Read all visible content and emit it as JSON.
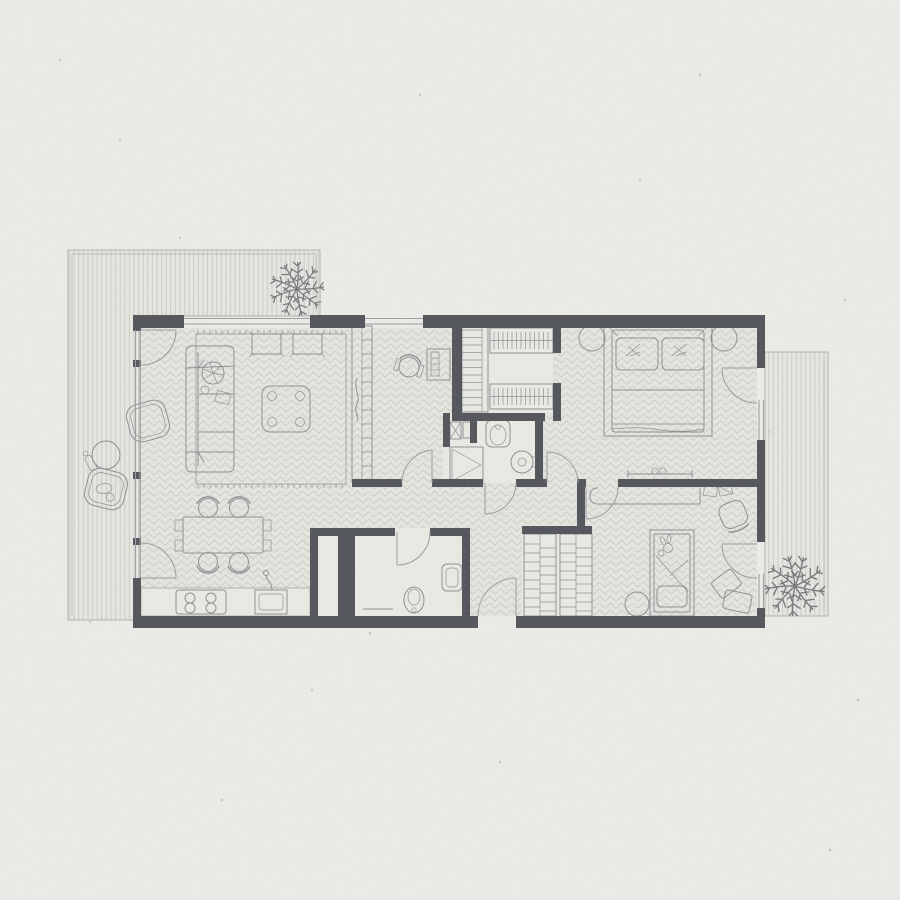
{
  "canvas": {
    "width": 900,
    "height": 900
  },
  "palette": {
    "paper": "#ecebe7",
    "wall": "#53565b",
    "floor_bg": "#e5e4df",
    "floor_line": "#c9c8c3",
    "deck_bg": "#e7e6e1",
    "deck_line": "#c6c5c0",
    "bath_bg": "#eae9e4",
    "furniture_stroke": "#8e9195",
    "furniture_fill": "#e9e8e3",
    "light_stroke": "#b2b1ac",
    "window_stroke": "#9aa0a4",
    "door_stroke": "#9a9da1",
    "plant_stroke": "#75787c",
    "speck": "#b5b3ae"
  },
  "floorplan": {
    "type": "apartment-top-view",
    "outdoor": {
      "left_terrace": {
        "surface": "deck-boards",
        "items": [
          "potted-fern",
          "lounge-chair",
          "lounge-chair",
          "round-side-table"
        ]
      },
      "right_terrace": {
        "surface": "deck-boards",
        "items": [
          "potted-fern"
        ]
      }
    },
    "rooms": [
      {
        "id": "living-dining",
        "floor": "herringbone",
        "items": [
          "sofa",
          "sofa-plant",
          "area-rug",
          "coffee-table",
          "floor-cushion",
          "floor-cushion",
          "shelf-partition-tv",
          "dining-table",
          "dining-chairs-x6",
          "kitchen-counter",
          "cooktop-4-burner",
          "kitchen-sink"
        ]
      },
      {
        "id": "office-nook",
        "floor": "herringbone",
        "items": [
          "desk",
          "office-chair"
        ]
      },
      {
        "id": "walk-in-closet",
        "floor": "plain",
        "items": [
          "shelf-ladder-unit",
          "hanging-rail",
          "hanging-rail"
        ]
      },
      {
        "id": "bathroom-main",
        "floor": "plain",
        "items": [
          "shower",
          "storage-niche",
          "vanity-sink",
          "round-basin"
        ]
      },
      {
        "id": "bathroom-guest",
        "floor": "plain",
        "items": [
          "toilet",
          "wall-sink",
          "towel-bar"
        ]
      },
      {
        "id": "hallway-entry",
        "floor": "herringbone",
        "items": [
          "wardrobe-unit",
          "wardrobe-unit"
        ]
      },
      {
        "id": "master-bedroom",
        "floor": "herringbone",
        "items": [
          "double-bed",
          "pillow",
          "pillow",
          "round-nightstand",
          "round-nightstand",
          "foot-bench"
        ]
      },
      {
        "id": "kids-bedroom",
        "floor": "herringbone",
        "items": [
          "single-bed",
          "bunny-toy",
          "wall-desk",
          "books",
          "desk-chair",
          "round-pouf",
          "floor-cushion",
          "floor-cushion"
        ]
      }
    ],
    "counts": {
      "doors": 10,
      "windows": 5,
      "plants": 3
    }
  }
}
